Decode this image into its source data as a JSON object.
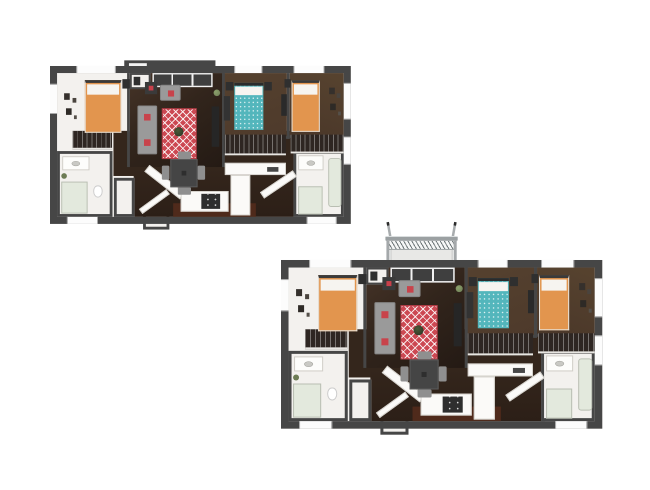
{
  "canvas": {
    "width": 650,
    "height": 490,
    "background": "#ffffff"
  },
  "palette": {
    "wall": "#464646",
    "white_room": "#f3f1ee",
    "wood": "#3a2b21",
    "wood_deep": "#241a14",
    "wood_mid": "#34261c",
    "wood_bed": "#4e3a2b",
    "kitchen_floor": "#4f2a1b",
    "bed_orange": "#e2954e",
    "bed_teal": "#53b6bc",
    "rug_red": "#cc4852",
    "pillow_red": "#c8434b",
    "sofa_gray": "#9a9a9a",
    "closet_dark": "#2e2622",
    "bath_green": "#e3e9dd",
    "balcony_gray": "#9ba0a2",
    "plant_green": "#6d7c55",
    "furn_dark": "#2f2f2f"
  },
  "plans": [
    {
      "id": "floorplan-upper-left",
      "variant": "entry-window",
      "bedrooms": 3,
      "bed_colors": [
        "orange",
        "teal",
        "orange"
      ]
    },
    {
      "id": "floorplan-lower-right",
      "variant": "balcony",
      "bedrooms": 3,
      "bed_colors": [
        "orange",
        "teal",
        "orange"
      ]
    }
  ]
}
